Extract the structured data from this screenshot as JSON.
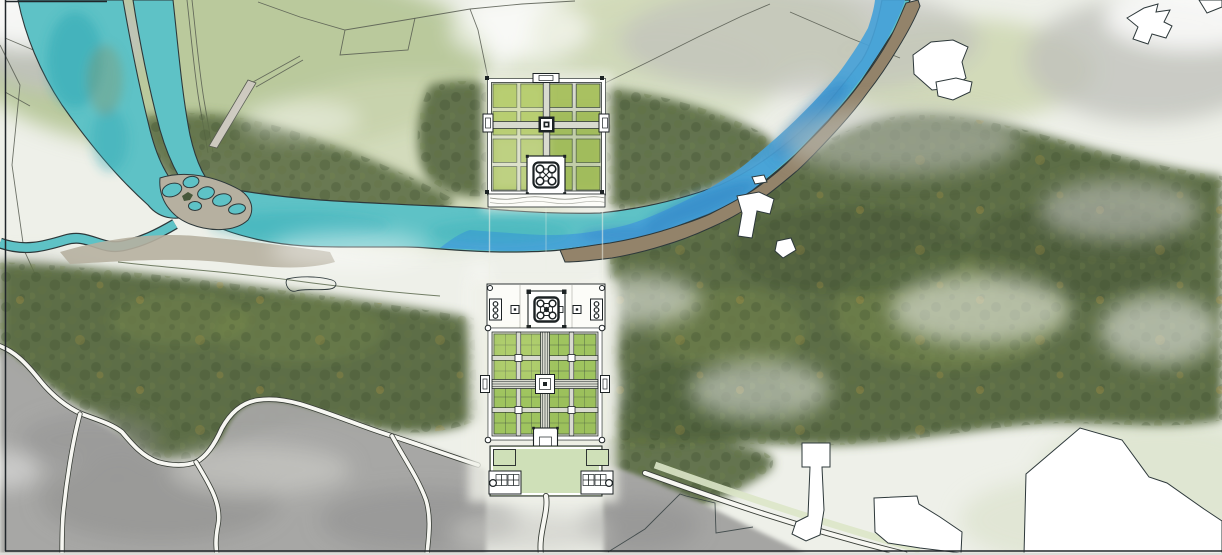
{
  "title": "watercolor-riverfront-garden-site-plan",
  "colors": {
    "paper": "#eef0e9",
    "field_light": "#ccd6b0",
    "field_mid": "#b4c493",
    "field_pale": "#ced8b8",
    "forest": "#5d6e46",
    "forest_deep": "#47573a",
    "forest_olive": "#77894e",
    "canopy_dark": "#3c4c2c",
    "canopy_mid": "#63753f",
    "canopy_accent": "#b5953f",
    "mist": "#c0c2bc",
    "white": "#ffffff",
    "town_gray": "#a5a5a3",
    "town_dark": "#8e8e8d",
    "town_light": "#c9c9c5",
    "bank_tan": "#b6b0a0",
    "sandbar": "#93836a",
    "river_teal": "#5ec2c6",
    "river_teal_deep": "#2fa8b4",
    "river_tint": "#8a8f62",
    "river_blue": "#48a2d8",
    "river_blue_deep": "#2c7fc2",
    "outline": "#2d383a",
    "line_field": "#565b50",
    "wall_white": "#ffffff",
    "path_gray": "#d8dacf",
    "plot_green": "#9fc45f",
    "plot_light": "#cfe08a",
    "plot_dark": "#8fae4f",
    "parterre_green": "#a9c161",
    "court_green": "#cfe0b8",
    "ink": "#1c2224",
    "road_white": "#f7f7f2",
    "road_edge": "#3a3f38",
    "road_green": "#dce6c8",
    "pale_strip": "#eff0e8",
    "structure_white": "#fcfcf8",
    "pale_br": "#dde4cf"
  },
  "structures": {
    "upper_garden": {
      "grid_cols": 4,
      "grid_rows": 4,
      "gates": 3,
      "corner_pavilion_circles": 4
    },
    "lower_garden": {
      "grid_cols": 4,
      "grid_rows": 4,
      "quadrants": 4,
      "central_pool": 1,
      "side_gates": 2
    },
    "river_terrace": {
      "mausoleum_minarets": 4,
      "dome": 1,
      "flanking_buildings": 2,
      "flanking_building_circles": 3
    },
    "forecourt": {
      "corner_courts": 2,
      "tomb_structures": 2,
      "tomb_circles": 1
    },
    "river": {
      "channels": 3,
      "braided_islands": 5
    }
  }
}
